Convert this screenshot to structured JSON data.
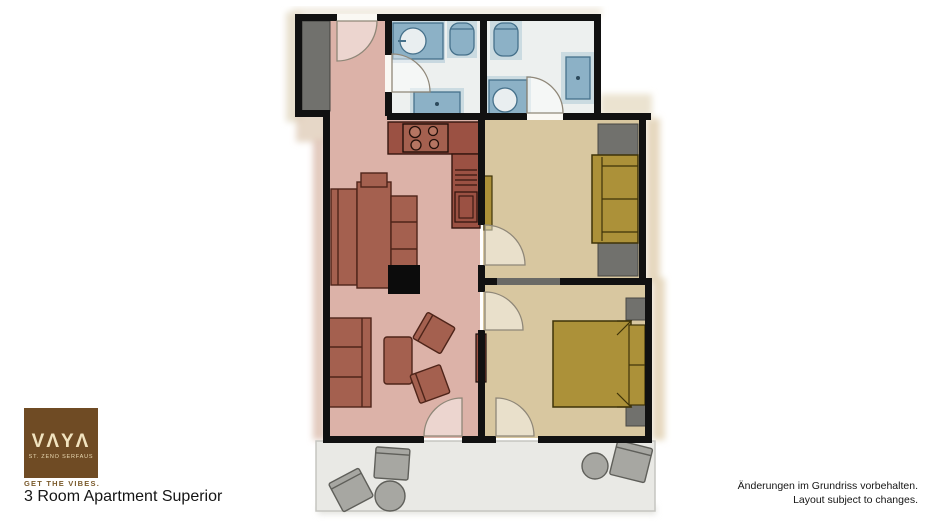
{
  "logo": {
    "brand": "VAYA",
    "display": "VΛYΛ",
    "subtitle": "ST. ZENO SERFAUS",
    "tagline": "GET THE VIBES.",
    "bg_color": "#6f4b24",
    "text_color": "#f1e3bf"
  },
  "title": "3 Room Apartment Superior",
  "disclaimer": {
    "line1": "Änderungen im Grundriss vorbehalten.",
    "line2": "Layout subject to changes."
  },
  "floorplan": {
    "type": "apartment-floor-plan",
    "rooms": [
      {
        "id": "entrance-hall",
        "floor_color": "#dcb2a8",
        "furniture": [
          "wardrobe"
        ]
      },
      {
        "id": "bathroom-1",
        "floor_color": "#edf0ef",
        "fixtures": [
          "sink",
          "toilet",
          "shower"
        ]
      },
      {
        "id": "bathroom-2",
        "floor_color": "#edf0ef",
        "fixtures": [
          "toilet",
          "shower",
          "sink"
        ]
      },
      {
        "id": "living-room-kitchen",
        "floor_color": "#dcb2a8",
        "furniture": [
          "kitchen-counter",
          "stove",
          "dining-bench",
          "fireplace",
          "sofa",
          "coffee-table",
          "armchair",
          "armchair"
        ]
      },
      {
        "id": "bedroom-1",
        "floor_color": "#d8c7a0",
        "furniture": [
          "wardrobe",
          "sofa-bed",
          "tv-board"
        ]
      },
      {
        "id": "bedroom-2",
        "floor_color": "#d8c7a0",
        "furniture": [
          "double-bed",
          "nightstand",
          "nightstand"
        ]
      },
      {
        "id": "terrace",
        "floor_color": "#e9e9e5",
        "furniture": [
          "chair",
          "chair",
          "round-table",
          "round-table",
          "chair"
        ]
      }
    ],
    "colors": {
      "wall": "#111111",
      "living_furniture": "#a4604f",
      "kitchen_counter": "#9b5143",
      "bedroom_furniture": "#ac9139",
      "bathroom_fixture": "#8cb1c6",
      "gray_furniture": "#71716d",
      "terrace_furniture": "#a7a7a2"
    }
  }
}
